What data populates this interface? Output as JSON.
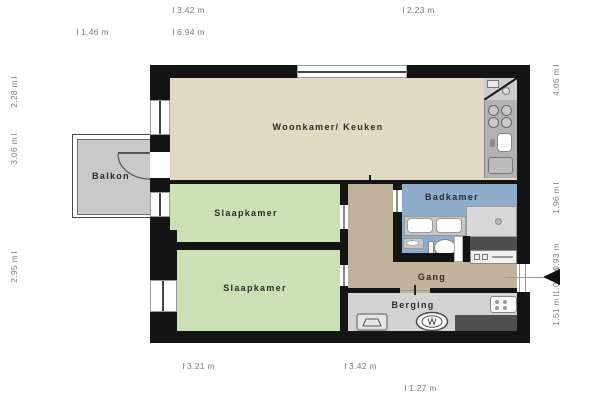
{
  "floorplan": {
    "rooms": {
      "living": {
        "label": "Woonkamer/ Keuken"
      },
      "bedroom1": {
        "label": "Slaapkamer"
      },
      "bedroom2": {
        "label": "Slaapkamer"
      },
      "bathroom": {
        "label": "Badkamer"
      },
      "hallway": {
        "label": "Gang"
      },
      "storage": {
        "label": "Berging"
      },
      "balcony": {
        "label": "Balkon"
      }
    },
    "dimensions": {
      "top_row1": [
        "3.42 m",
        "2.23 m"
      ],
      "top_row2": [
        "1.46 m",
        "6.94 m"
      ],
      "left": [
        "2.28 m",
        "3.06 m",
        "2.95 m"
      ],
      "right": [
        "4.06 m",
        "1.96 m",
        "0.93 m",
        "1.09 m",
        "1.51 m"
      ],
      "bottom_row1": [
        "3.21 m",
        "3.42 m"
      ],
      "bottom_row2": [
        "1.27 m"
      ]
    },
    "colors": {
      "wall": "#141414",
      "living": "#e1d9c2",
      "bedroom": "#cbe1b5",
      "bathroom": "#8fadcb",
      "hallway": "#c2b29c",
      "storage": "#d3d3d3",
      "balcony": "#c9c9c9",
      "kitchen_counter": "#b2b2b2"
    },
    "icons": [
      "entrance-arrow",
      "stove",
      "kitchen-sink",
      "counter-appliance",
      "shower",
      "double-sink-vanity",
      "washbasin",
      "toilet",
      "washing-machine",
      "doormat",
      "boiler",
      "dark-counter"
    ]
  }
}
